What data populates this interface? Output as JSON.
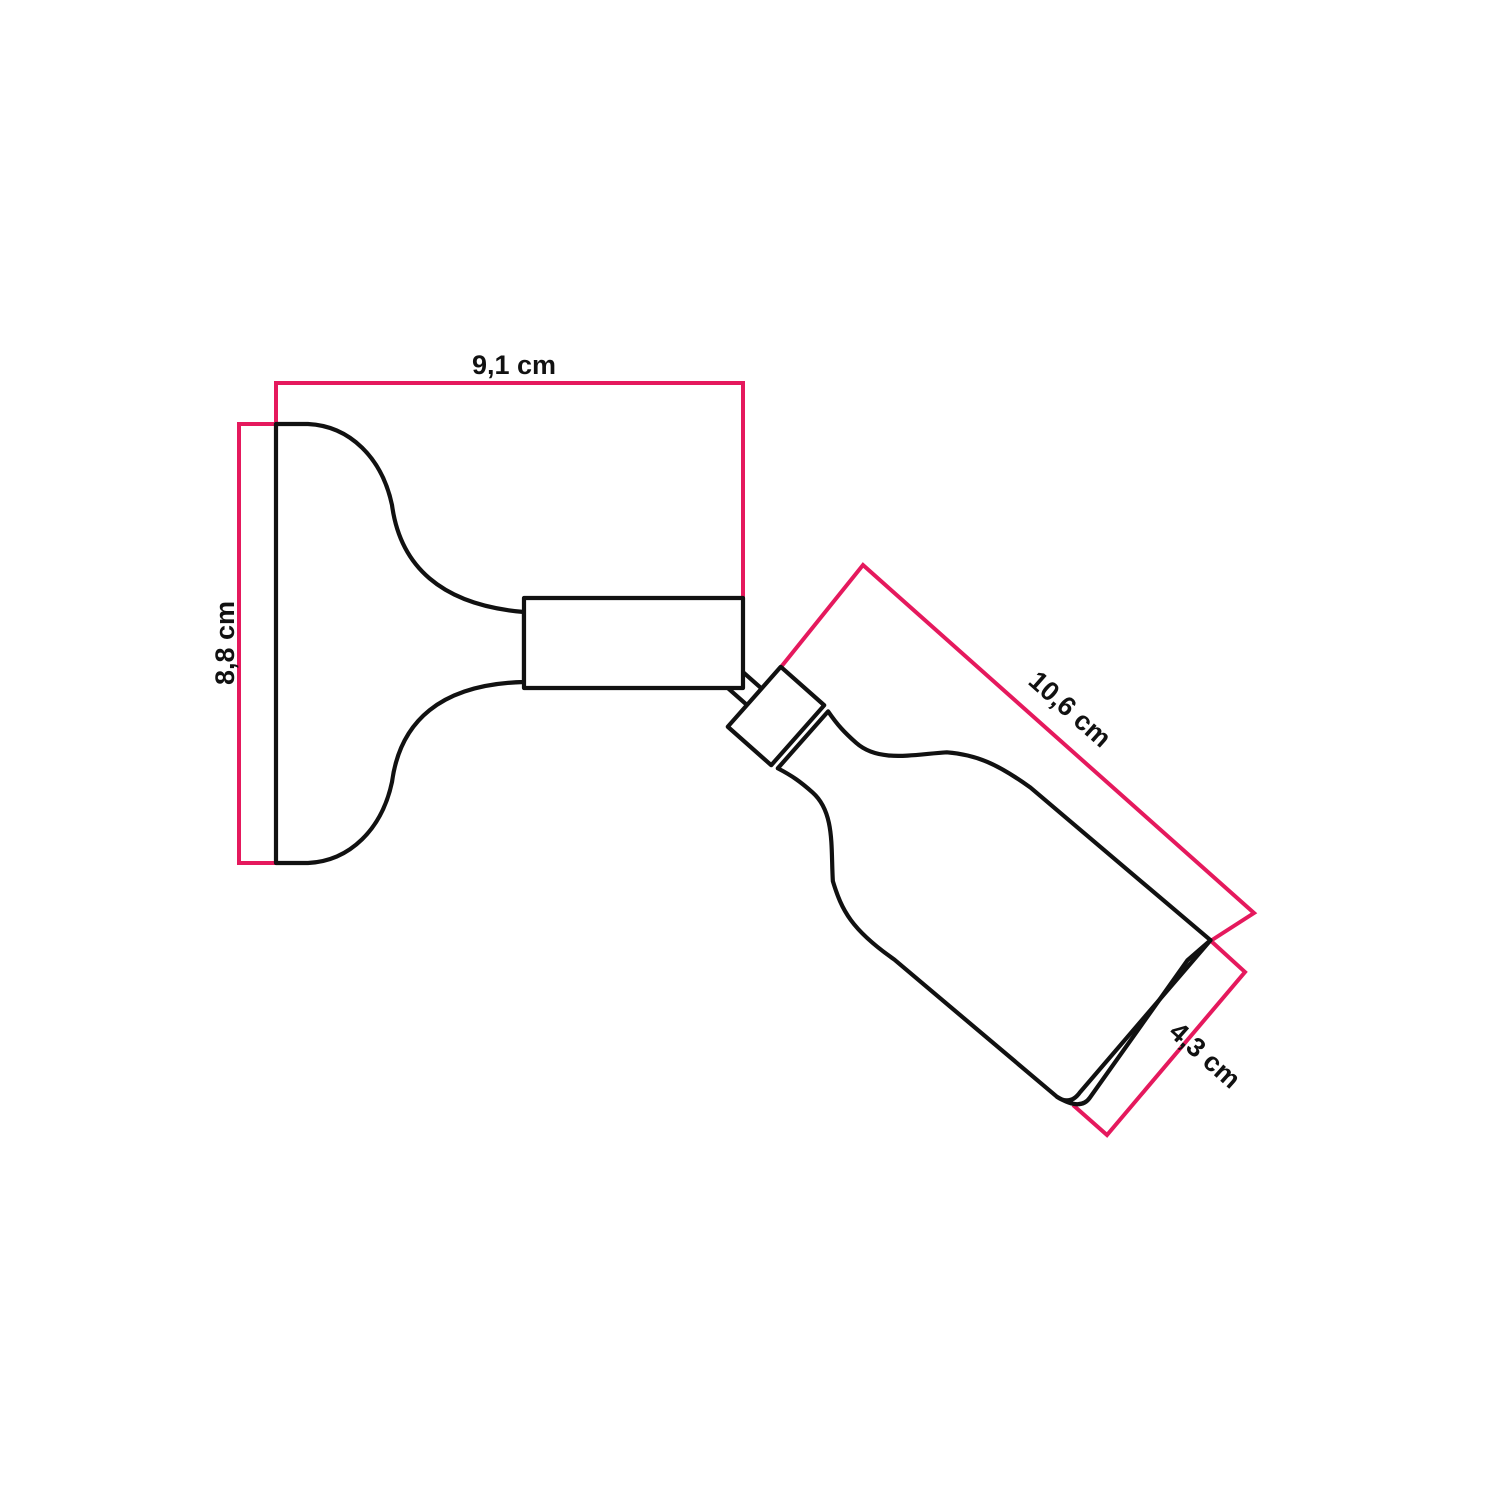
{
  "diagram": {
    "dimensions": {
      "base_width_label": "9,1 cm",
      "base_height_label": "8,8 cm",
      "holder_length_label": "10,6 cm",
      "holder_diameter_label": "4,3 cm"
    },
    "colors": {
      "dimension_line": "#e5195d",
      "outline": "#111111",
      "background": "#ffffff"
    }
  }
}
